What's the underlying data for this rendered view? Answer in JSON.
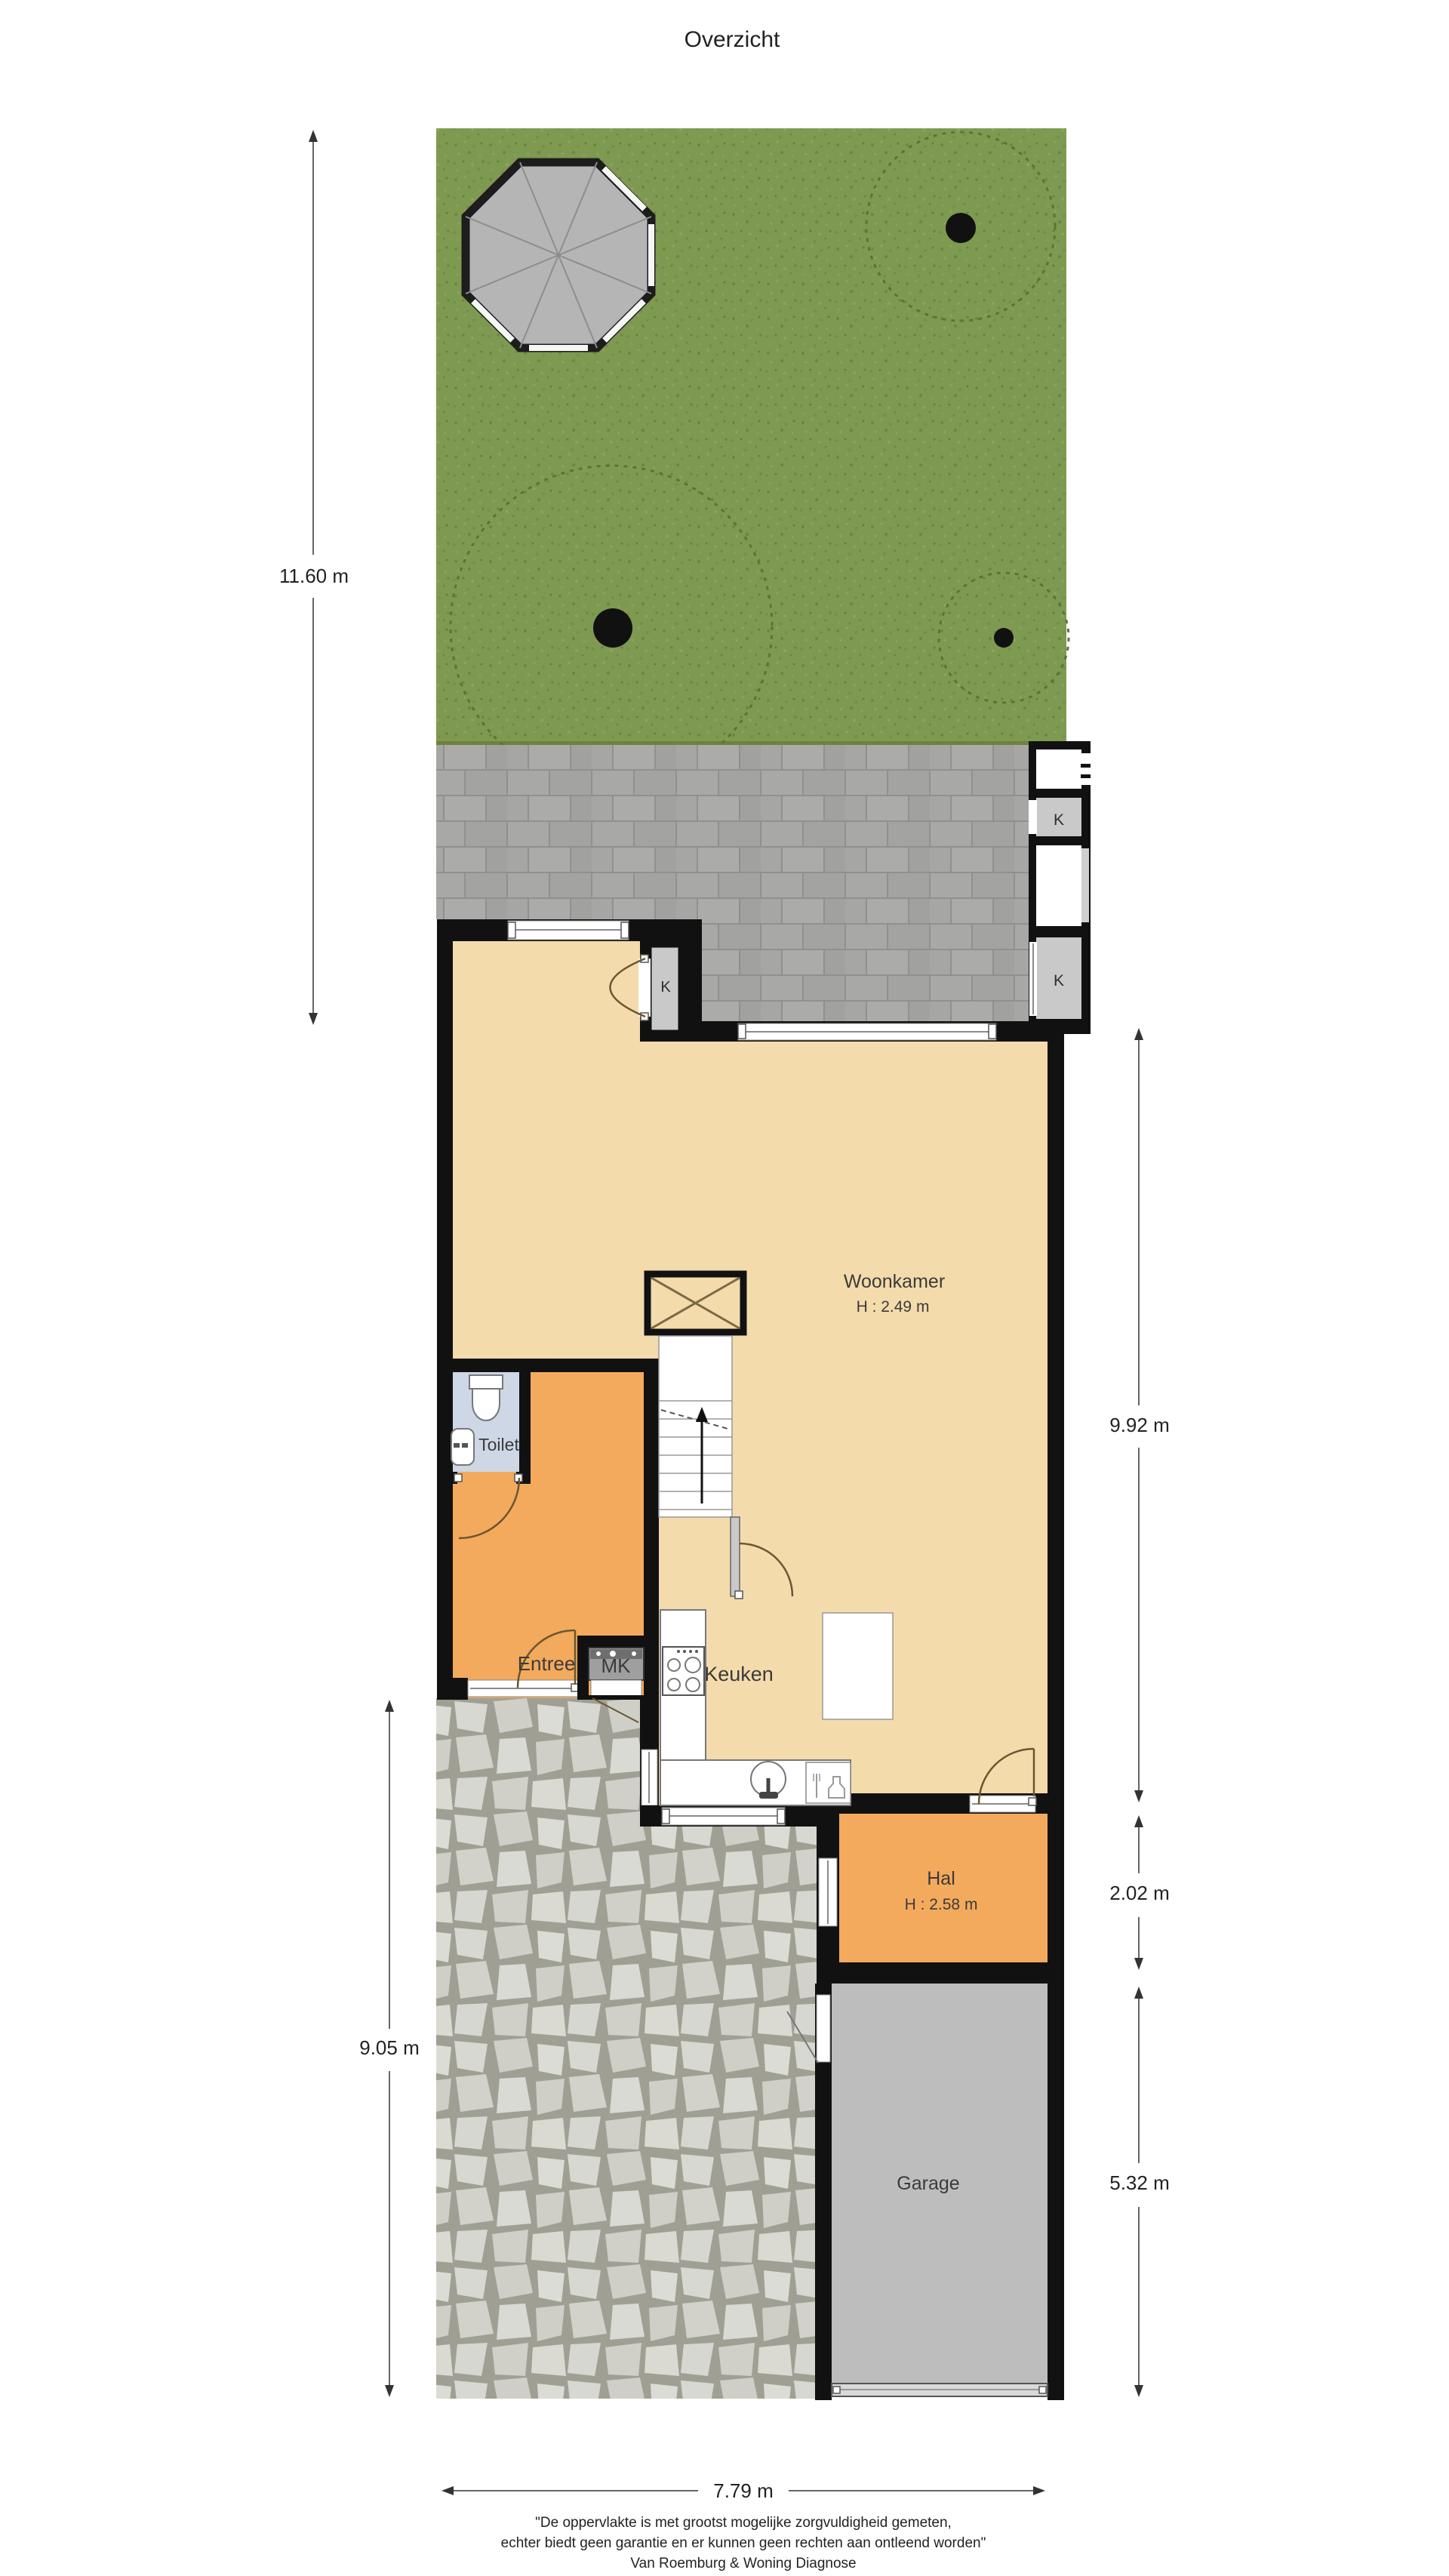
{
  "title": "Overzicht",
  "rooms": {
    "woonkamer": {
      "label": "Woonkamer",
      "height": "H : 2.49 m"
    },
    "toilet": {
      "label": "Toilet"
    },
    "entree": {
      "label": "Entree"
    },
    "mk": {
      "label": "MK"
    },
    "keuken": {
      "label": "Keuken"
    },
    "hal": {
      "label": "Hal",
      "height": "H : 2.58 m"
    },
    "garage": {
      "label": "Garage"
    },
    "kast_shed_top": {
      "label": "K"
    },
    "kast_shed_bottom": {
      "label": "K"
    },
    "kast_backdoor": {
      "label": "K"
    }
  },
  "dimensions": {
    "garden_depth": "11.60 m",
    "living_depth": "9.92 m",
    "hal_depth": "2.02 m",
    "front_depth": "9.05 m",
    "garage_depth": "5.32 m",
    "plot_width": "7.79 m"
  },
  "footer": {
    "line1": "\"De oppervlakte is met grootst mogelijke zorgvuldigheid gemeten,",
    "line2": "echter biedt geen garantie en er kunnen geen rechten aan ontleend worden\"",
    "line3": "Van Roemburg & Woning Diagnose"
  },
  "colors": {
    "grass": "#7e9a50",
    "brick_terrace": "#a6a6a4",
    "flagstone": "#d6d6d0",
    "floor_living": "#f4dbab",
    "floor_hall": "#f3aa5d",
    "floor_toilet": "#cdd7e5",
    "garage_floor": "#bdbdbd",
    "shed_k": "#c9c9c9",
    "wall": "#111111"
  }
}
